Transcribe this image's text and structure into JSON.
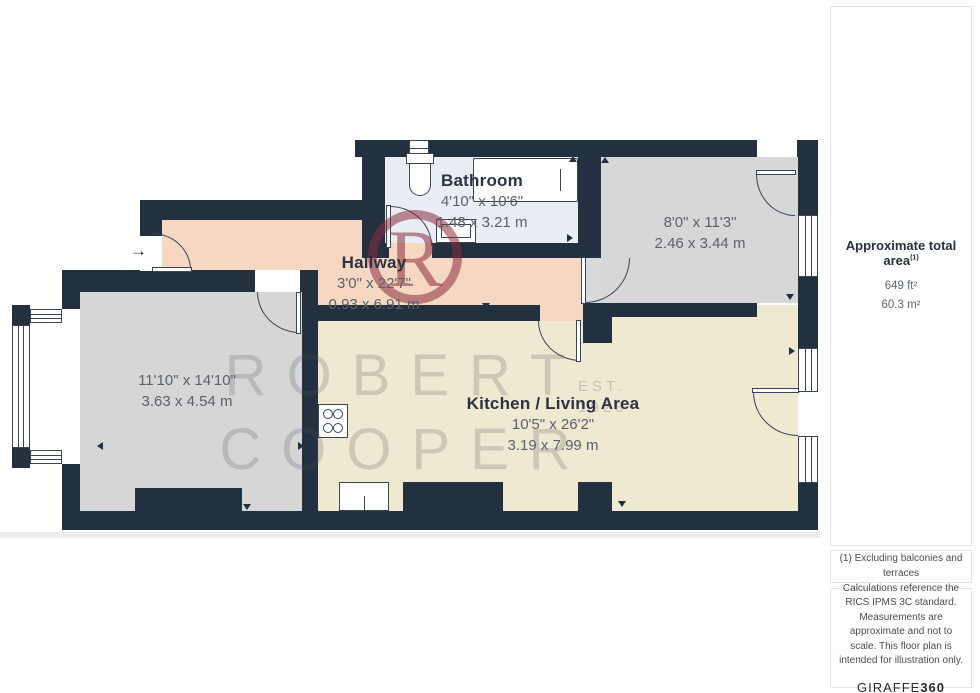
{
  "plan": {
    "rooms": [
      {
        "name": "Bathroom",
        "imperial": "4'10\" x 10'6\"",
        "metric": "1.48 x 3.21 m"
      },
      {
        "name": "Hallway",
        "imperial": "3'0\" x 22'7\"",
        "metric": "0.93 x 6.91 m"
      },
      {
        "name": "",
        "imperial": "8'0\" x 11'3\"",
        "metric": "2.46 x 3.44 m"
      },
      {
        "name": "",
        "imperial": "11'10\" x 14'10\"",
        "metric": "3.63 x 4.54 m"
      },
      {
        "name": "Kitchen / Living Area",
        "imperial": "10'5\" x 26'2\"",
        "metric": "3.19 x 7.99 m"
      }
    ],
    "entry_arrow": "→",
    "colors": {
      "wall": "#233040",
      "hallway": "#f6d7c2",
      "bathroom": "#e9edf4",
      "bedroom_gray": "#d6d6d6",
      "kitchen_cream": "#f0e9d1",
      "logo_red": "#8d2b3e"
    }
  },
  "watermark": {
    "line1": "ROBERT",
    "line2": "COOPER",
    "est": "EST.",
    "year": "1928",
    "monogram": "R"
  },
  "sidebar": {
    "area_title": "Approximate total area",
    "area_superscript": "(1)",
    "area_ft": "649 ft²",
    "area_m": "60.3 m²",
    "footnote": "(1) Excluding balconies and terraces",
    "disclaimer": "Calculations reference the RICS IPMS 3C standard. Measurements are approximate and not to scale. This floor plan is intended for illustration only.",
    "brand_name": "GIRAFFE",
    "brand_suffix": "360"
  }
}
